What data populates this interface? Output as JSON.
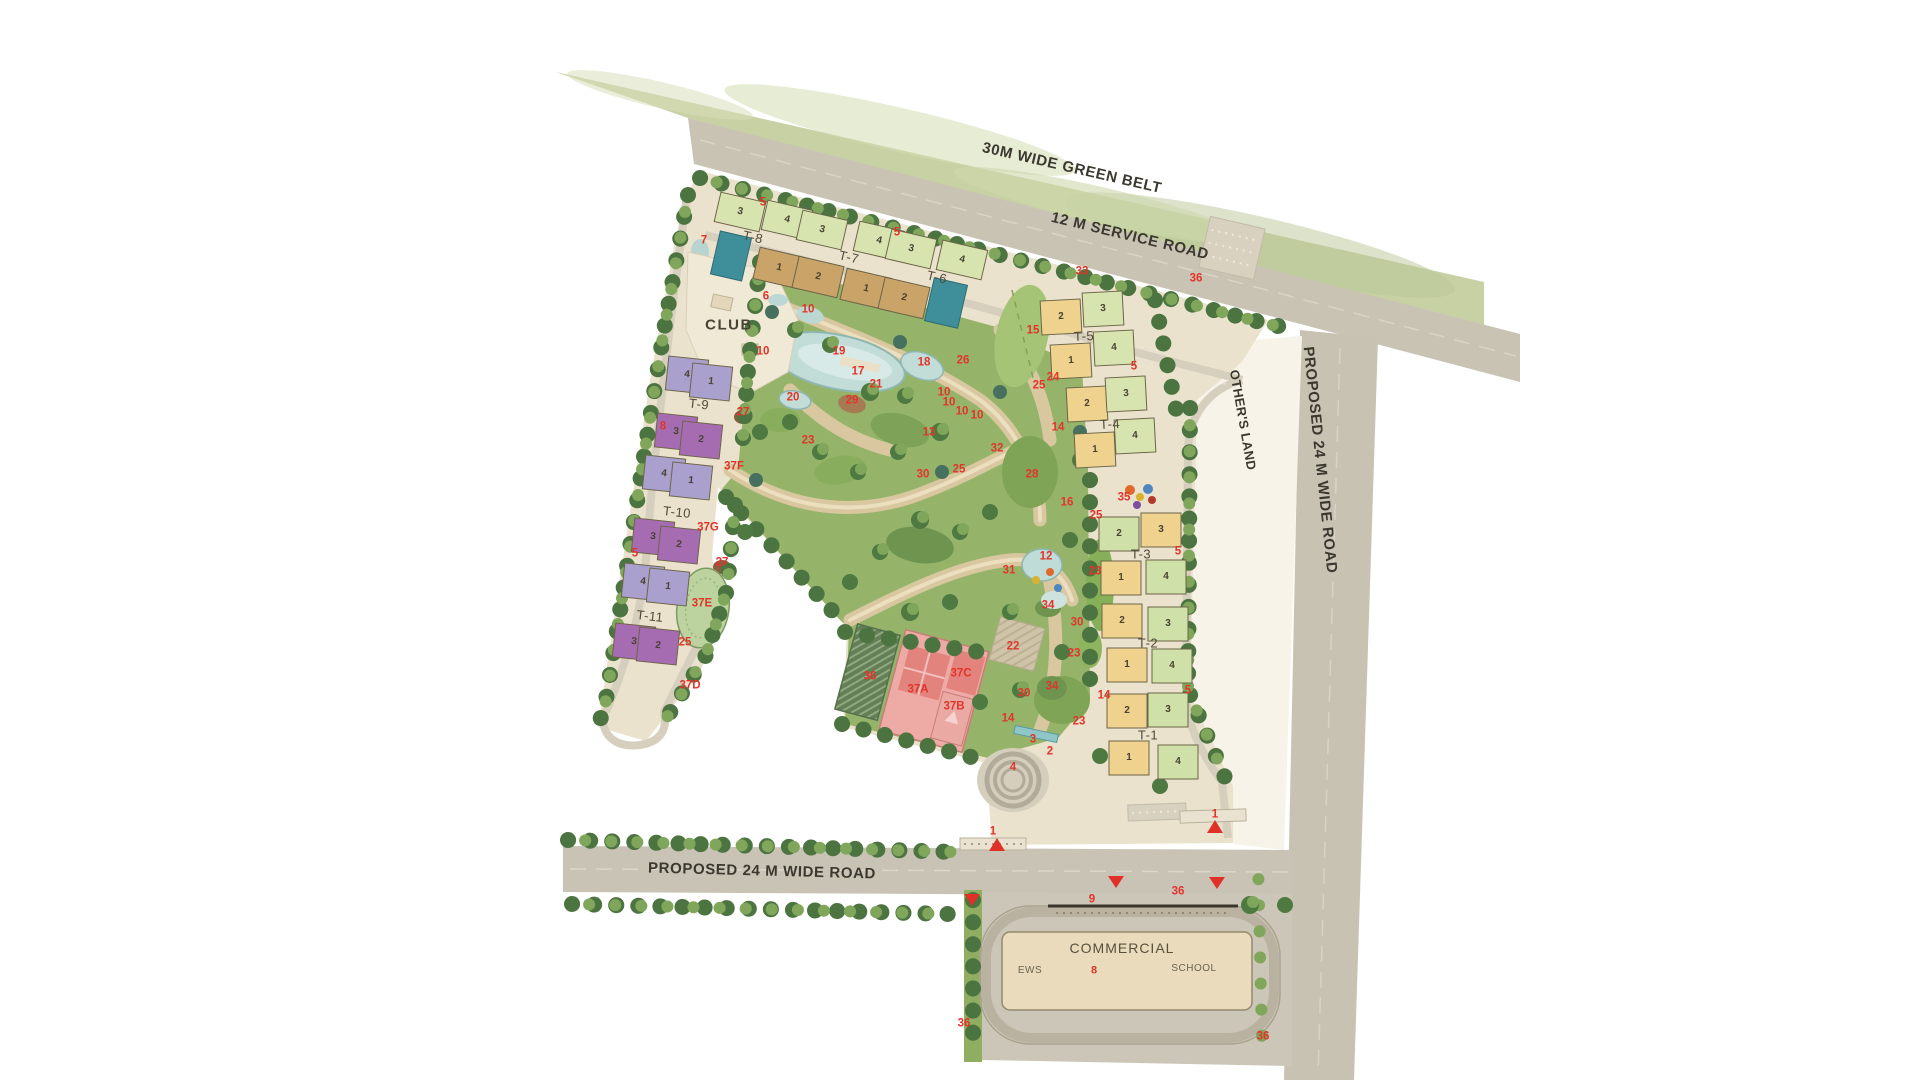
{
  "colors": {
    "green_belt": "#c7d1a4",
    "road": "#c9c3b4",
    "site_base": "#eae2cc",
    "park_green": "#95b46a",
    "lake": "#c2dcd8",
    "tan_building": "#c9a368",
    "lightgreen_building": "#d8e4b0",
    "teal_building": "#3e8f99",
    "purple_light": "#a9a0cd",
    "purple_dark": "#a66cb2",
    "yellow_building": "#efd28e",
    "pink_building": "#eeaaa5",
    "marker_red": "#e2342a"
  },
  "label_groups": {
    "road_labels": [
      {
        "t": "30M WIDE GREEN BELT",
        "x": 1072,
        "y": 168,
        "r": 13
      },
      {
        "t": "12 M SERVICE ROAD",
        "x": 1130,
        "y": 236,
        "r": 13.5
      },
      {
        "t": "OTHER'S LAND",
        "x": 1243,
        "y": 420,
        "r": 80,
        "c": "land"
      },
      {
        "t": "PROPOSED 24 M WIDE ROAD",
        "x": 1320,
        "y": 460,
        "r": 84
      },
      {
        "t": "PROPOSED 24 M WIDE ROAD",
        "x": 762,
        "y": 871,
        "r": 1.5
      }
    ],
    "area_labels": [
      {
        "t": "CLUB",
        "x": 729,
        "y": 325,
        "c": "club"
      },
      {
        "t": "COMMERCIAL",
        "x": 1122,
        "y": 948,
        "c": "comm"
      },
      {
        "t": "EWS",
        "x": 1030,
        "y": 971,
        "c": "comm-sub"
      },
      {
        "t": "8",
        "x": 1094,
        "y": 971,
        "c": "comm-red"
      },
      {
        "t": "SCHOOL",
        "x": 1194,
        "y": 969,
        "c": "comm-sub"
      }
    ],
    "tower_labels": [
      {
        "t": "T-8",
        "x": 753,
        "y": 237,
        "r": 13
      },
      {
        "t": "T-7",
        "x": 849,
        "y": 257,
        "r": 13
      },
      {
        "t": "T-6",
        "x": 937,
        "y": 277,
        "r": 13
      },
      {
        "t": "T-5",
        "x": 1084,
        "y": 336,
        "r": -3
      },
      {
        "t": "T-4",
        "x": 1110,
        "y": 424,
        "r": -3
      },
      {
        "t": "T-3",
        "x": 1141,
        "y": 554
      },
      {
        "t": "T-2",
        "x": 1148,
        "y": 643
      },
      {
        "t": "T-1",
        "x": 1148,
        "y": 735
      },
      {
        "t": "T-9",
        "x": 699,
        "y": 404,
        "r": 6
      },
      {
        "t": "T-10",
        "x": 677,
        "y": 512,
        "r": 6
      },
      {
        "t": "T-11",
        "x": 650,
        "y": 616,
        "r": 6
      }
    ],
    "wing_numbers": [
      {
        "t": "3",
        "x": 740,
        "y": 212,
        "r": 13
      },
      {
        "t": "4",
        "x": 787,
        "y": 220,
        "r": 13
      },
      {
        "t": "3",
        "x": 822,
        "y": 230,
        "r": 13
      },
      {
        "t": "4",
        "x": 879,
        "y": 241,
        "r": 13
      },
      {
        "t": "3",
        "x": 911,
        "y": 249,
        "r": 13
      },
      {
        "t": "4",
        "x": 962,
        "y": 260,
        "r": 13
      },
      {
        "t": "1",
        "x": 779,
        "y": 268,
        "r": 13
      },
      {
        "t": "2",
        "x": 818,
        "y": 277,
        "r": 13
      },
      {
        "t": "1",
        "x": 866,
        "y": 289,
        "r": 13
      },
      {
        "t": "2",
        "x": 904,
        "y": 298,
        "r": 13
      },
      {
        "t": "2",
        "x": 1061,
        "y": 317,
        "r": -3
      },
      {
        "t": "3",
        "x": 1103,
        "y": 309,
        "r": -3
      },
      {
        "t": "1",
        "x": 1071,
        "y": 361,
        "r": -3
      },
      {
        "t": "4",
        "x": 1114,
        "y": 348,
        "r": -3
      },
      {
        "t": "2",
        "x": 1087,
        "y": 404,
        "r": -3
      },
      {
        "t": "3",
        "x": 1126,
        "y": 394,
        "r": -3
      },
      {
        "t": "1",
        "x": 1095,
        "y": 450,
        "r": -3
      },
      {
        "t": "4",
        "x": 1135,
        "y": 436,
        "r": -3
      },
      {
        "t": "2",
        "x": 1119,
        "y": 534
      },
      {
        "t": "3",
        "x": 1161,
        "y": 530
      },
      {
        "t": "1",
        "x": 1121,
        "y": 578
      },
      {
        "t": "4",
        "x": 1166,
        "y": 577
      },
      {
        "t": "2",
        "x": 1122,
        "y": 621
      },
      {
        "t": "3",
        "x": 1168,
        "y": 624
      },
      {
        "t": "1",
        "x": 1127,
        "y": 665
      },
      {
        "t": "4",
        "x": 1172,
        "y": 666
      },
      {
        "t": "2",
        "x": 1127,
        "y": 711
      },
      {
        "t": "3",
        "x": 1168,
        "y": 710
      },
      {
        "t": "1",
        "x": 1129,
        "y": 758
      },
      {
        "t": "4",
        "x": 1178,
        "y": 762
      },
      {
        "t": "4",
        "x": 687,
        "y": 375,
        "r": 6
      },
      {
        "t": "1",
        "x": 711,
        "y": 382,
        "r": 6
      },
      {
        "t": "3",
        "x": 676,
        "y": 432,
        "r": 6
      },
      {
        "t": "2",
        "x": 701,
        "y": 440,
        "r": 6
      },
      {
        "t": "4",
        "x": 664,
        "y": 474,
        "r": 6
      },
      {
        "t": "1",
        "x": 691,
        "y": 481,
        "r": 6
      },
      {
        "t": "3",
        "x": 653,
        "y": 537,
        "r": 6
      },
      {
        "t": "2",
        "x": 679,
        "y": 545,
        "r": 6
      },
      {
        "t": "4",
        "x": 643,
        "y": 582,
        "r": 6
      },
      {
        "t": "1",
        "x": 668,
        "y": 587,
        "r": 6
      },
      {
        "t": "3",
        "x": 634,
        "y": 642,
        "r": 6
      },
      {
        "t": "2",
        "x": 658,
        "y": 646,
        "r": 6
      }
    ],
    "amenity_markers": [
      {
        "t": "5",
        "x": 763,
        "y": 203
      },
      {
        "t": "7",
        "x": 704,
        "y": 241
      },
      {
        "t": "5",
        "x": 897,
        "y": 233
      },
      {
        "t": "33",
        "x": 1082,
        "y": 272
      },
      {
        "t": "36",
        "x": 1196,
        "y": 279
      },
      {
        "t": "6",
        "x": 766,
        "y": 297
      },
      {
        "t": "10",
        "x": 808,
        "y": 310
      },
      {
        "t": "15",
        "x": 1033,
        "y": 331
      },
      {
        "t": "10",
        "x": 763,
        "y": 352
      },
      {
        "t": "19",
        "x": 839,
        "y": 352
      },
      {
        "t": "26",
        "x": 963,
        "y": 361
      },
      {
        "t": "18",
        "x": 924,
        "y": 363
      },
      {
        "t": "5",
        "x": 1134,
        "y": 367
      },
      {
        "t": "17",
        "x": 858,
        "y": 372
      },
      {
        "t": "24",
        "x": 1053,
        "y": 378
      },
      {
        "t": "25",
        "x": 1039,
        "y": 386
      },
      {
        "t": "21",
        "x": 876,
        "y": 385
      },
      {
        "t": "20",
        "x": 793,
        "y": 398
      },
      {
        "t": "29",
        "x": 852,
        "y": 401
      },
      {
        "t": "10",
        "x": 944,
        "y": 393
      },
      {
        "t": "10",
        "x": 949,
        "y": 403
      },
      {
        "t": "10",
        "x": 962,
        "y": 412
      },
      {
        "t": "10",
        "x": 977,
        "y": 416
      },
      {
        "t": "8",
        "x": 663,
        "y": 427
      },
      {
        "t": "27",
        "x": 743,
        "y": 413
      },
      {
        "t": "14",
        "x": 1058,
        "y": 428
      },
      {
        "t": "13",
        "x": 929,
        "y": 433
      },
      {
        "t": "23",
        "x": 808,
        "y": 441
      },
      {
        "t": "32",
        "x": 997,
        "y": 449
      },
      {
        "t": "30",
        "x": 923,
        "y": 475
      },
      {
        "t": "25",
        "x": 959,
        "y": 470
      },
      {
        "t": "28",
        "x": 1032,
        "y": 475
      },
      {
        "t": "37F",
        "x": 734,
        "y": 467
      },
      {
        "t": "16",
        "x": 1067,
        "y": 503
      },
      {
        "t": "35",
        "x": 1124,
        "y": 498
      },
      {
        "t": "25",
        "x": 1096,
        "y": 516
      },
      {
        "t": "37G",
        "x": 708,
        "y": 528
      },
      {
        "t": "23",
        "x": 1095,
        "y": 572
      },
      {
        "t": "12",
        "x": 1046,
        "y": 557
      },
      {
        "t": "31",
        "x": 1009,
        "y": 571
      },
      {
        "t": "5",
        "x": 1178,
        "y": 552
      },
      {
        "t": "27",
        "x": 722,
        "y": 563
      },
      {
        "t": "5",
        "x": 635,
        "y": 554
      },
      {
        "t": "34",
        "x": 1048,
        "y": 606
      },
      {
        "t": "37E",
        "x": 702,
        "y": 604
      },
      {
        "t": "30",
        "x": 1077,
        "y": 623
      },
      {
        "t": "22",
        "x": 1013,
        "y": 647
      },
      {
        "t": "23",
        "x": 1074,
        "y": 654
      },
      {
        "t": "25",
        "x": 685,
        "y": 643
      },
      {
        "t": "37D",
        "x": 690,
        "y": 686
      },
      {
        "t": "5",
        "x": 1188,
        "y": 691
      },
      {
        "t": "34",
        "x": 1052,
        "y": 687
      },
      {
        "t": "30",
        "x": 1024,
        "y": 694
      },
      {
        "t": "14",
        "x": 1104,
        "y": 696
      },
      {
        "t": "14",
        "x": 1008,
        "y": 719
      },
      {
        "t": "23",
        "x": 1079,
        "y": 722
      },
      {
        "t": "36",
        "x": 870,
        "y": 677
      },
      {
        "t": "37A",
        "x": 918,
        "y": 690
      },
      {
        "t": "37C",
        "x": 961,
        "y": 674
      },
      {
        "t": "37B",
        "x": 954,
        "y": 707
      },
      {
        "t": "3",
        "x": 1033,
        "y": 740
      },
      {
        "t": "2",
        "x": 1050,
        "y": 752
      },
      {
        "t": "4",
        "x": 1013,
        "y": 768
      },
      {
        "t": "1",
        "x": 993,
        "y": 832
      },
      {
        "t": "1",
        "x": 1215,
        "y": 815
      },
      {
        "t": "9",
        "x": 1092,
        "y": 900
      },
      {
        "t": "36",
        "x": 1178,
        "y": 892
      },
      {
        "t": "36",
        "x": 964,
        "y": 1024
      },
      {
        "t": "36",
        "x": 1263,
        "y": 1037
      }
    ]
  }
}
